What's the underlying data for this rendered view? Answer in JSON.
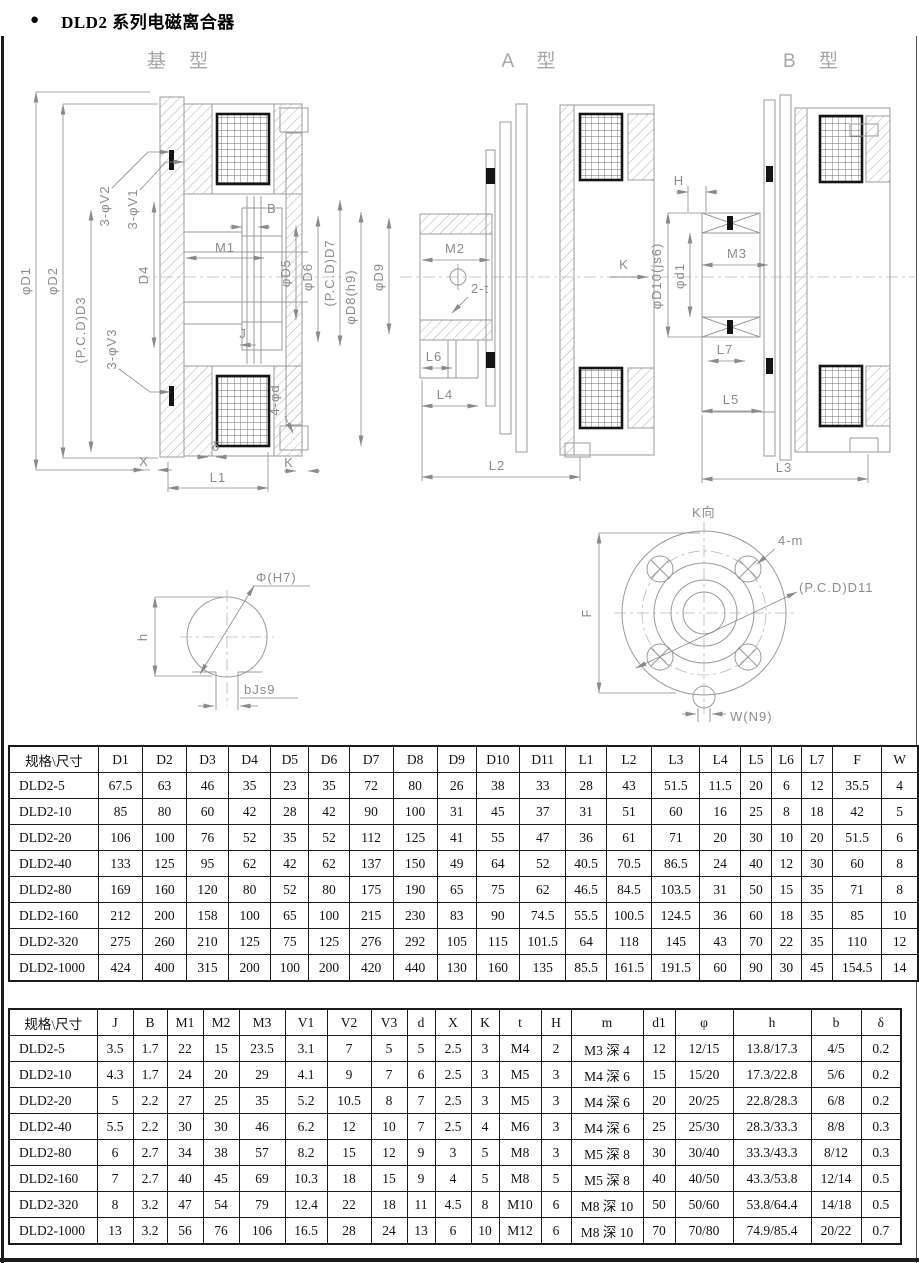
{
  "page": {
    "bullet": "●",
    "title": "DLD2 系列电磁离合器"
  },
  "drawings": {
    "basic": {
      "title": "基 型",
      "labels": {
        "d1": "φD1",
        "d2": "φD2",
        "d3": "(P.C.D)D3",
        "v2": "3-φV2",
        "v1": "3-φV1",
        "d4": "D4",
        "b": "B",
        "m1": "M1",
        "j": "J",
        "d5": "φD5",
        "d6": "φD6",
        "d7": "(P.C.D)D7",
        "d8": "φD8(h9)",
        "v3": "3-φV3",
        "fourd": "4-φd",
        "x": "X",
        "delta": "δ",
        "k": "K",
        "l1": "L1"
      }
    },
    "typeA": {
      "title": "A 型",
      "labels": {
        "m2": "M2",
        "t": "2-t",
        "d9": "φD9",
        "l6": "L6",
        "l4": "L4",
        "l2": "L2",
        "k": "K"
      }
    },
    "typeB": {
      "title": "B 型",
      "labels": {
        "h": "H",
        "d10": "φD10(js6)",
        "m3": "M3",
        "d1": "φd1",
        "l7": "L7",
        "l5": "L5",
        "l3": "L3"
      }
    },
    "keyway": {
      "labels": {
        "phi": "Φ(H7)",
        "h": "h",
        "b": "bJs9"
      }
    },
    "flange": {
      "labels": {
        "k": "K向",
        "m": "4-m",
        "pcd": "(P.C.D)D11",
        "f": "F",
        "w": "W(N9)"
      }
    }
  },
  "table1": {
    "headers": [
      "规格\\尺寸",
      "D1",
      "D2",
      "D3",
      "D4",
      "D5",
      "D6",
      "D7",
      "D8",
      "D9",
      "D10",
      "D11",
      "L1",
      "L2",
      "L3",
      "L4",
      "L5",
      "L6",
      "L7",
      "F",
      "W"
    ],
    "rows": [
      [
        "DLD2-5",
        "67.5",
        "63",
        "46",
        "35",
        "23",
        "35",
        "72",
        "80",
        "26",
        "38",
        "33",
        "28",
        "43",
        "51.5",
        "11.5",
        "20",
        "6",
        "12",
        "35.5",
        "4"
      ],
      [
        "DLD2-10",
        "85",
        "80",
        "60",
        "42",
        "28",
        "42",
        "90",
        "100",
        "31",
        "45",
        "37",
        "31",
        "51",
        "60",
        "16",
        "25",
        "8",
        "18",
        "42",
        "5"
      ],
      [
        "DLD2-20",
        "106",
        "100",
        "76",
        "52",
        "35",
        "52",
        "112",
        "125",
        "41",
        "55",
        "47",
        "36",
        "61",
        "71",
        "20",
        "30",
        "10",
        "20",
        "51.5",
        "6"
      ],
      [
        "DLD2-40",
        "133",
        "125",
        "95",
        "62",
        "42",
        "62",
        "137",
        "150",
        "49",
        "64",
        "52",
        "40.5",
        "70.5",
        "86.5",
        "24",
        "40",
        "12",
        "30",
        "60",
        "8"
      ],
      [
        "DLD2-80",
        "169",
        "160",
        "120",
        "80",
        "52",
        "80",
        "175",
        "190",
        "65",
        "75",
        "62",
        "46.5",
        "84.5",
        "103.5",
        "31",
        "50",
        "15",
        "35",
        "71",
        "8"
      ],
      [
        "DLD2-160",
        "212",
        "200",
        "158",
        "100",
        "65",
        "100",
        "215",
        "230",
        "83",
        "90",
        "74.5",
        "55.5",
        "100.5",
        "124.5",
        "36",
        "60",
        "18",
        "35",
        "85",
        "10"
      ],
      [
        "DLD2-320",
        "275",
        "260",
        "210",
        "125",
        "75",
        "125",
        "276",
        "292",
        "105",
        "115",
        "101.5",
        "64",
        "118",
        "145",
        "43",
        "70",
        "22",
        "35",
        "110",
        "12"
      ],
      [
        "DLD2-1000",
        "424",
        "400",
        "315",
        "200",
        "100",
        "200",
        "420",
        "440",
        "130",
        "160",
        "135",
        "85.5",
        "161.5",
        "191.5",
        "60",
        "90",
        "30",
        "45",
        "154.5",
        "14"
      ]
    ]
  },
  "table2": {
    "headers": [
      "规格\\尺寸",
      "J",
      "B",
      "M1",
      "M2",
      "M3",
      "V1",
      "V2",
      "V3",
      "d",
      "X",
      "K",
      "t",
      "H",
      "m",
      "d1",
      "φ",
      "h",
      "b",
      "δ"
    ],
    "rows": [
      [
        "DLD2-5",
        "3.5",
        "1.7",
        "22",
        "15",
        "23.5",
        "3.1",
        "7",
        "5",
        "5",
        "2.5",
        "3",
        "M4",
        "2",
        "M3 深 4",
        "12",
        "12/15",
        "13.8/17.3",
        "4/5",
        "0.2"
      ],
      [
        "DLD2-10",
        "4.3",
        "1.7",
        "24",
        "20",
        "29",
        "4.1",
        "9",
        "7",
        "6",
        "2.5",
        "3",
        "M5",
        "3",
        "M4 深 6",
        "15",
        "15/20",
        "17.3/22.8",
        "5/6",
        "0.2"
      ],
      [
        "DLD2-20",
        "5",
        "2.2",
        "27",
        "25",
        "35",
        "5.2",
        "10.5",
        "8",
        "7",
        "2.5",
        "3",
        "M5",
        "3",
        "M4 深 6",
        "20",
        "20/25",
        "22.8/28.3",
        "6/8",
        "0.2"
      ],
      [
        "DLD2-40",
        "5.5",
        "2.2",
        "30",
        "30",
        "46",
        "6.2",
        "12",
        "10",
        "7",
        "2.5",
        "4",
        "M6",
        "3",
        "M4 深 6",
        "25",
        "25/30",
        "28.3/33.3",
        "8/8",
        "0.3"
      ],
      [
        "DLD2-80",
        "6",
        "2.7",
        "34",
        "38",
        "57",
        "8.2",
        "15",
        "12",
        "9",
        "3",
        "5",
        "M8",
        "3",
        "M5 深 8",
        "30",
        "30/40",
        "33.3/43.3",
        "8/12",
        "0.3"
      ],
      [
        "DLD2-160",
        "7",
        "2.7",
        "40",
        "45",
        "69",
        "10.3",
        "18",
        "15",
        "9",
        "4",
        "5",
        "M8",
        "5",
        "M5 深 8",
        "40",
        "40/50",
        "43.3/53.8",
        "12/14",
        "0.5"
      ],
      [
        "DLD2-320",
        "8",
        "3.2",
        "47",
        "54",
        "79",
        "12.4",
        "22",
        "18",
        "11",
        "4.5",
        "8",
        "M10",
        "6",
        "M8 深 10",
        "50",
        "50/60",
        "53.8/64.4",
        "14/18",
        "0.5"
      ],
      [
        "DLD2-1000",
        "13",
        "3.2",
        "56",
        "76",
        "106",
        "16.5",
        "28",
        "24",
        "13",
        "6",
        "10",
        "M12",
        "6",
        "M8 深 10",
        "70",
        "70/80",
        "74.9/85.4",
        "20/22",
        "0.7"
      ]
    ]
  }
}
